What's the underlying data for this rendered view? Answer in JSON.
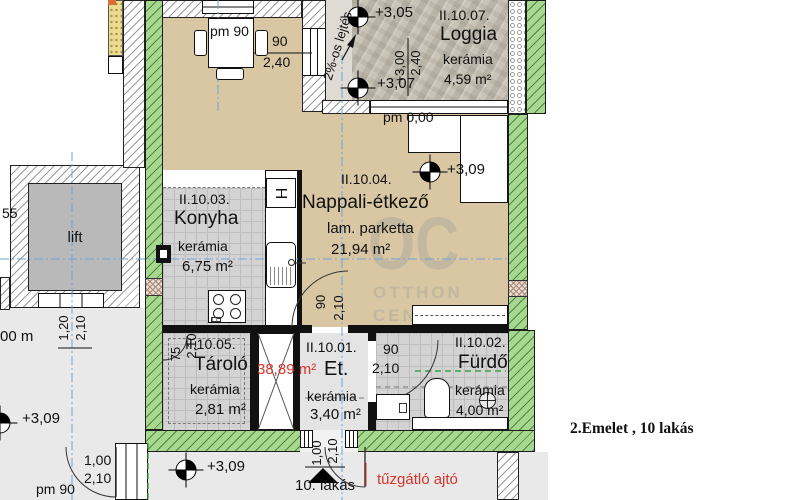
{
  "title": "2.Emelet , 10 lakás",
  "watermark": {
    "big": "OC",
    "line1": "OTTHON",
    "line2": "CENTRUM"
  },
  "rooms": {
    "loggia": {
      "id": "II.10.07.",
      "name": "Loggia",
      "floor": "kerámia",
      "area": "4,59 m²"
    },
    "konyha": {
      "id": "II.10.03.",
      "name": "Konyha",
      "floor": "kerámia",
      "area": "6,75 m²"
    },
    "nappali": {
      "id": "II.10.04.",
      "name": "Nappali-étkező",
      "floor": "lam. parketta",
      "area": "21,94 m²"
    },
    "tarolo": {
      "id": "II.10.05.",
      "name": "Tároló",
      "floor": "kerámia",
      "area": "2,81 m²"
    },
    "eloter": {
      "id": "II.10.01.",
      "name": "Et.",
      "floor": "kerámia",
      "area": "3,40 m²"
    },
    "furdo": {
      "id": "II.10.02.",
      "name": "Fürdő",
      "floor": "kerámia",
      "area": "4,00 m²"
    },
    "lift": {
      "name": "lift"
    }
  },
  "levels": {
    "l305": "+3,05",
    "l307": "+3,07",
    "l309": "+3,09",
    "l300": "+3,00",
    "pm000": "pm 0,00",
    "pm90": "pm 90"
  },
  "dims": {
    "d90": "90",
    "d240": "2,40",
    "d210": "2,10",
    "d75": "75",
    "d120": "1,20",
    "d100": "1,00",
    "d55": "55",
    "d00m": "00 m"
  },
  "annotations": {
    "slope": "2%-os lejtés",
    "total_area": "38,89 m²",
    "apartment": "10. lakás",
    "fire_door": "tűzgátló ajtó"
  },
  "colors": {
    "wall_green": "#a8d88f",
    "floor_tan": "#d8c7a2",
    "tile_gray": "#d3d3d3",
    "accent_red": "#d8342a",
    "axis_blue": "#6fa3d8",
    "watermark_gray": "#beb5a0"
  }
}
